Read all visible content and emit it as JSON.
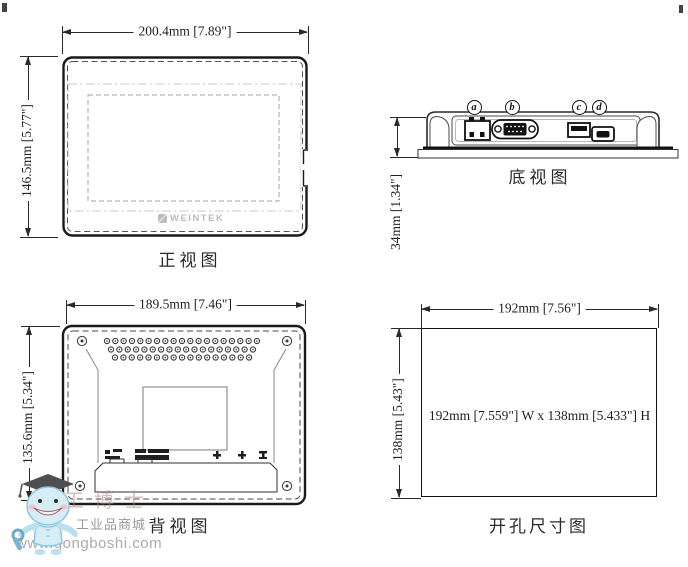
{
  "drawing": {
    "views": {
      "front": {
        "title": "正视图",
        "width_dim": "200.4mm [7.89\"]",
        "height_dim": "146.5mm [5.77\"]",
        "logo": "WEINTEK"
      },
      "bottom": {
        "title": "底视图",
        "height_dim": "34mm [1.34\"]",
        "ports": [
          {
            "label": "a",
            "name": "power-terminal"
          },
          {
            "label": "b",
            "name": "serial-db9"
          },
          {
            "label": "c",
            "name": "usb-host"
          },
          {
            "label": "d",
            "name": "usb-client"
          }
        ]
      },
      "back": {
        "title": "背视图",
        "width_dim": "189.5mm [7.46\"]",
        "height_dim": "135.6mm [5.34\"]"
      },
      "cutout": {
        "title": "开孔尺寸图",
        "width_dim": "192mm [7.56\"]",
        "height_dim": "138mm [5.43\"]",
        "center_label": "192mm [7.559\"] W x 138mm [5.433\"] H"
      }
    },
    "colors": {
      "line": "#2a2a2a",
      "light_line": "#c8c8c8",
      "logo_gray": "#c0c0c0",
      "watermark_blue": "#cfeaf7",
      "watermark_text": "#9a9a9a"
    }
  },
  "watermark": {
    "brand": "工博士",
    "store": "工业品商城",
    "url": "www.gongboshi.com"
  }
}
